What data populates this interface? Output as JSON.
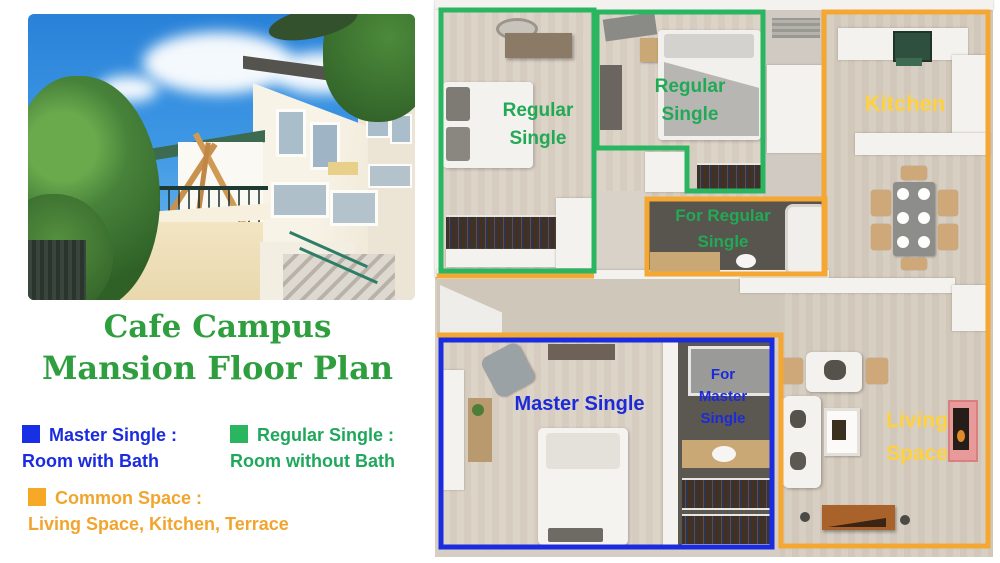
{
  "title": {
    "line1": "Cafe Campus",
    "line2": "Mansion Floor Plan",
    "color": "#2f9e3e"
  },
  "legend": {
    "items": [
      {
        "label": "Master Single :",
        "description": "Room with Bath",
        "color": "#1730e5",
        "text_color": "#1b2ce0"
      },
      {
        "label": "Regular Single :",
        "description": "Room without Bath",
        "color": "#2ab561",
        "text_color": "#1fa85c"
      },
      {
        "label": "Common Space :",
        "description": "Living Space, Kitchen, Terrace",
        "color": "#f6a826",
        "text_color": "#f2a52e"
      }
    ]
  },
  "floor_plan": {
    "labels": {
      "regular_single_1": "Regular Single",
      "regular_single_2": "Regular Single",
      "for_regular_single": "For Regular Single",
      "kitchen": "Kitchen",
      "master_single": "Master Single",
      "for_master_single": "For Master Single",
      "living_space": "Living Space"
    },
    "colors": {
      "regular_single_outline": "#2ab561",
      "master_single_outline": "#1b2ce0",
      "common_space_outline": "#f5a733",
      "regular_label": "#22a956",
      "master_label": "#1d2ad8",
      "common_label": "#ffd13c"
    }
  },
  "photo": {
    "caption": "building-exterior-photo"
  }
}
